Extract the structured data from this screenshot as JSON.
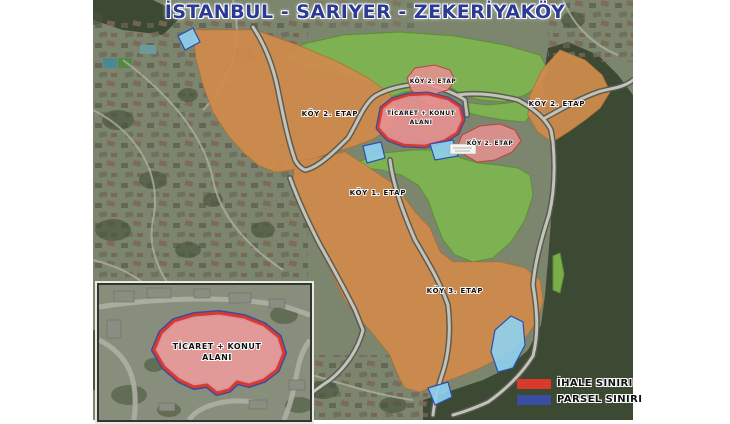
{
  "title": "İSTANBUL - SARIYER - ZEKERİYAKÖY",
  "map": {
    "zone_labels": [
      {
        "id": "koy-2-etap-west",
        "text": "KÖY 2. ETAP"
      },
      {
        "id": "koy-2-etap-north-pink",
        "text": "KÖY 2. ETAP"
      },
      {
        "id": "koy-2-etap-east",
        "text": "KÖY 2. ETAP"
      },
      {
        "id": "koy-2-etap-east-pink",
        "text": "KÖY 2. ETAP"
      },
      {
        "id": "koy-1-etap",
        "text": "KÖY 1. ETAP"
      },
      {
        "id": "koy-3-etap",
        "text": "KÖY 3. ETAP"
      },
      {
        "id": "ticaret-konut-line1",
        "text": "TİCARET + KONUT"
      },
      {
        "id": "ticaret-konut-line2",
        "text": "ALANI"
      }
    ]
  },
  "inset": {
    "label_line1": "TİCARET + KONUT",
    "label_line2": "ALANI"
  },
  "legend": {
    "items": [
      {
        "label": "İHALE SINIRI",
        "color": "#d93a2b"
      },
      {
        "label": "PARSEL SINIRI",
        "color": "#3a4da3"
      }
    ]
  },
  "colors": {
    "title_blue": "#2b3a94",
    "zone_orange": "#cf8b4d",
    "zone_green": "#7fb94e",
    "zone_pink": "#e89090",
    "ihale_border_red": "#d93a2b",
    "parsel_border_blue": "#3a4da3",
    "water_blue": "#8ed2ef"
  }
}
